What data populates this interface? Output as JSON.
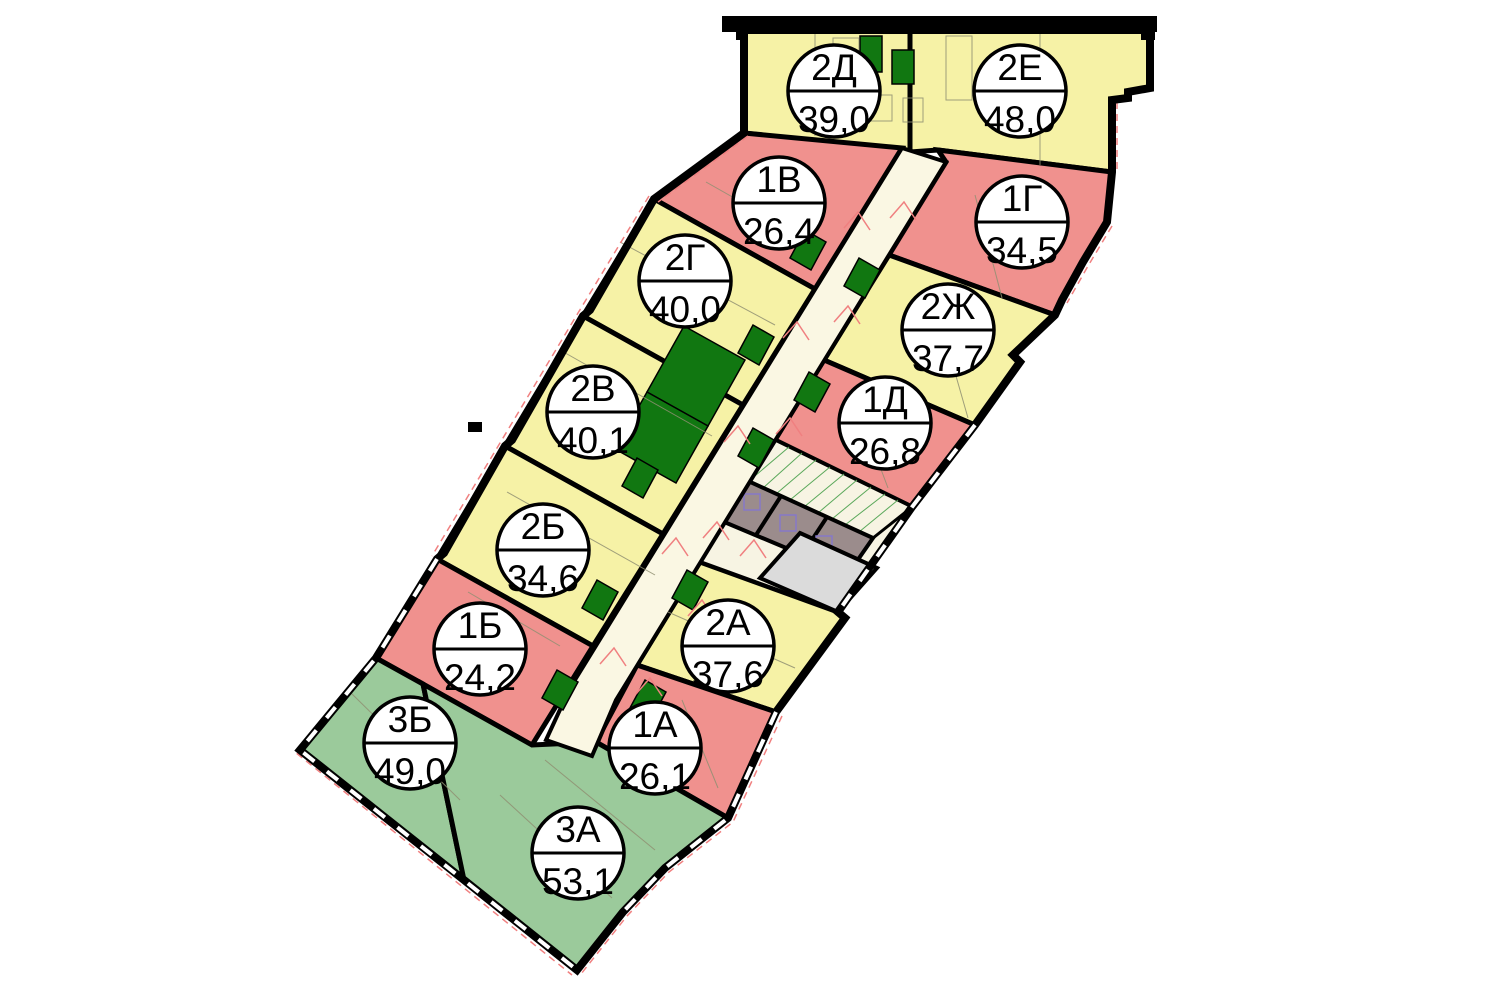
{
  "plan": {
    "kind": "residential-floor-plan",
    "background": "#ffffff"
  },
  "palette": {
    "one_room": "#F0918E",
    "two_room": "#F6F2A6",
    "three_room": "#9BCA9B",
    "corridor": "#FAF7E3",
    "core_vestibule": "#F7F4E3",
    "elevator_block": "#9B8C8C",
    "service_gray": "#DBDBDB",
    "shaft_green": "#117711",
    "wall": "#000000",
    "accent_red": "#F08080",
    "elevator_symbol": "#8678C8",
    "stair_tread": "#5AA85A"
  },
  "apartments": [
    {
      "label": "2Д",
      "area": "39,0",
      "rooms": 2,
      "color": "#F6F2A6"
    },
    {
      "label": "2Е",
      "area": "48,0",
      "rooms": 2,
      "color": "#F6F2A6"
    },
    {
      "label": "1В",
      "area": "26,4",
      "rooms": 1,
      "color": "#F0918E"
    },
    {
      "label": "1Г",
      "area": "34,5",
      "rooms": 1,
      "color": "#F0918E"
    },
    {
      "label": "2Г",
      "area": "40,0",
      "rooms": 2,
      "color": "#F6F2A6"
    },
    {
      "label": "2Ж",
      "area": "37,7",
      "rooms": 2,
      "color": "#F6F2A6"
    },
    {
      "label": "2В",
      "area": "40,1",
      "rooms": 2,
      "color": "#F6F2A6"
    },
    {
      "label": "1Д",
      "area": "26,8",
      "rooms": 1,
      "color": "#F0918E"
    },
    {
      "label": "2Б",
      "area": "34,6",
      "rooms": 2,
      "color": "#F6F2A6"
    },
    {
      "label": "1Б",
      "area": "24,2",
      "rooms": 1,
      "color": "#F0918E"
    },
    {
      "label": "2А",
      "area": "37,6",
      "rooms": 2,
      "color": "#F6F2A6"
    },
    {
      "label": "1А",
      "area": "26,1",
      "rooms": 1,
      "color": "#F0918E"
    },
    {
      "label": "3Б",
      "area": "49,0",
      "rooms": 3,
      "color": "#9BCA9B"
    },
    {
      "label": "3А",
      "area": "53,1",
      "rooms": 3,
      "color": "#9BCA9B"
    }
  ]
}
